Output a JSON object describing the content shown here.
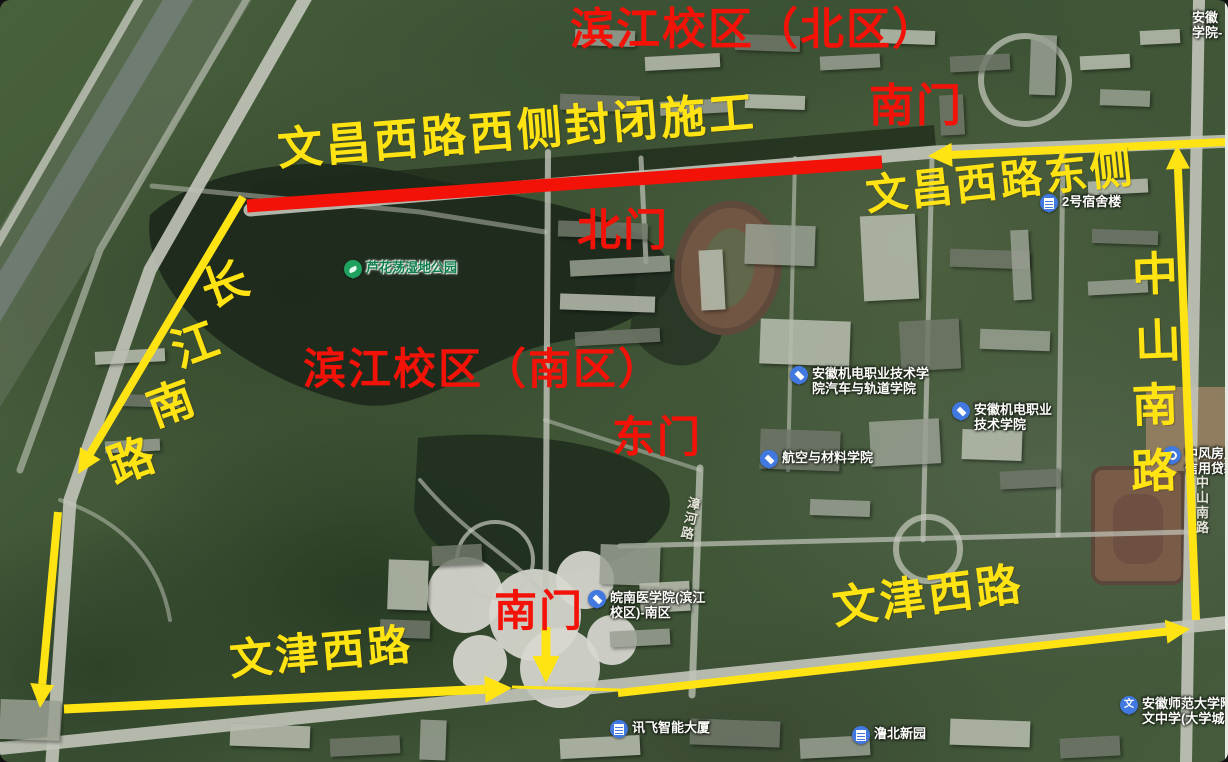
{
  "colors": {
    "annotation_red": "#f31208",
    "annotation_yellow": "#ffe312",
    "poi_blue": "#4179e0",
    "poi_green": "#1fa15f"
  },
  "annotations": {
    "red_texts": [
      {
        "id": "campus-north-title",
        "text": "滨江校区（北区）",
        "x": 570,
        "y": 8,
        "size": 44,
        "rotate": 0
      },
      {
        "id": "south-gate-north-campus",
        "text": "南门",
        "x": 869,
        "y": 84,
        "size": 45,
        "rotate": 0
      },
      {
        "id": "north-gate",
        "text": "北门",
        "x": 577,
        "y": 209,
        "size": 44,
        "rotate": 0
      },
      {
        "id": "campus-south-title",
        "text": "滨江校区（南区）",
        "x": 303,
        "y": 349,
        "size": 43,
        "rotate": 0
      },
      {
        "id": "east-gate",
        "text": "东门",
        "x": 612,
        "y": 417,
        "size": 43,
        "rotate": 0
      },
      {
        "id": "south-gate-south-campus",
        "text": "南门",
        "x": 494,
        "y": 591,
        "size": 43,
        "rotate": 0
      }
    ],
    "yellow_texts": [
      {
        "id": "closure-notice",
        "text": "文昌西路西侧封闭施工",
        "x": 276,
        "y": 128,
        "size": 45,
        "rotate": -4.5
      },
      {
        "id": "wenchang-east-label",
        "text": "文昌西路东侧",
        "x": 864,
        "y": 176,
        "size": 42,
        "rotate": -6
      },
      {
        "id": "wenjin-west-label-left",
        "text": "文津西路",
        "x": 228,
        "y": 640,
        "size": 43,
        "rotate": -5
      },
      {
        "id": "wenjin-west-label-right",
        "text": "文津西路",
        "x": 830,
        "y": 587,
        "size": 45,
        "rotate": -7.5
      }
    ],
    "vertical_texts": [
      {
        "id": "changjiang-south-road",
        "text": "长江南路",
        "size": 46,
        "rotate": -20,
        "chars": [
          {
            "c": "长",
            "x": 202,
            "y": 262
          },
          {
            "c": "江",
            "x": 172,
            "y": 322
          },
          {
            "c": "南",
            "x": 148,
            "y": 381
          },
          {
            "c": "路",
            "x": 108,
            "y": 438
          }
        ]
      },
      {
        "id": "zhongshan-south-road",
        "text": "中山南路",
        "size": 46,
        "rotate": -2,
        "chars": [
          {
            "c": "中",
            "x": 1132,
            "y": 252
          },
          {
            "c": "山",
            "x": 1135,
            "y": 319
          },
          {
            "c": "南",
            "x": 1132,
            "y": 383
          },
          {
            "c": "路",
            "x": 1131,
            "y": 449
          }
        ]
      }
    ],
    "red_line": {
      "id": "closure-red-line",
      "x1": 247,
      "y1": 206,
      "x2": 882,
      "y2": 162,
      "width": 13
    },
    "arrows": [
      {
        "id": "arrow-changjiang-upper",
        "x1": 243,
        "y1": 197,
        "x2": 78,
        "y2": 474,
        "width": 8
      },
      {
        "id": "arrow-changjiang-lower",
        "x1": 58,
        "y1": 512,
        "x2": 40,
        "y2": 708,
        "width": 8
      },
      {
        "id": "arrow-wenchang-westbound",
        "x1": 1226,
        "y1": 142,
        "x2": 928,
        "y2": 156,
        "width": 8
      },
      {
        "id": "arrow-zhongshan-northbound",
        "x1": 1196,
        "y1": 620,
        "x2": 1177,
        "y2": 145,
        "width": 8
      },
      {
        "id": "arrow-wenjin-eastbound-left",
        "x1": 64,
        "y1": 709,
        "x2": 512,
        "y2": 688,
        "width": 9
      },
      {
        "id": "arrow-wenjin-eastbound-right",
        "x1": 618,
        "y1": 693,
        "x2": 1190,
        "y2": 629,
        "width": 8
      },
      {
        "id": "arrow-south-gate-down",
        "x1": 546,
        "y1": 627,
        "x2": 546,
        "y2": 683,
        "width": 9
      }
    ],
    "thin_lines": [
      {
        "id": "wenjin-connector",
        "x1": 512,
        "y1": 687,
        "x2": 620,
        "y2": 690,
        "width": 3
      }
    ]
  },
  "pois": [
    {
      "id": "luhuadang-wetland-park",
      "lines": [
        "芦花荡湿地公园"
      ],
      "x": 344,
      "y": 260,
      "pin": "leaf",
      "style": "green"
    },
    {
      "id": "dormitory-2",
      "lines": [
        "2号宿舍楼"
      ],
      "x": 1040,
      "y": 194,
      "pin": "building",
      "style": "blue"
    },
    {
      "id": "jidian-auto-rail-college",
      "lines": [
        "安徽机电职业技术学",
        "院汽车与轨道学院"
      ],
      "x": 790,
      "y": 366,
      "pin": "grad",
      "style": "blue"
    },
    {
      "id": "jidian-vocational-college",
      "lines": [
        "安徽机电职业",
        "技术学院"
      ],
      "x": 952,
      "y": 402,
      "pin": "grad",
      "style": "blue"
    },
    {
      "id": "aero-materials-college",
      "lines": [
        "航空与材料学院"
      ],
      "x": 760,
      "y": 450,
      "pin": "grad",
      "style": "blue"
    },
    {
      "id": "wannan-medical-south",
      "lines": [
        "皖南医学院(滨江",
        "校区)-南区"
      ],
      "x": 588,
      "y": 590,
      "pin": "grad",
      "style": "blue"
    },
    {
      "id": "zhongfeng-property-loan",
      "lines": [
        "中风房产",
        "信用贷款"
      ],
      "x": 1163,
      "y": 446,
      "pin": "dot",
      "style": "blue"
    },
    {
      "id": "xunfei-tower",
      "lines": [
        "讯飞智能大厦"
      ],
      "x": 610,
      "y": 720,
      "pin": "building",
      "style": "blue"
    },
    {
      "id": "lubei-xinyuan",
      "lines": [
        "澛北新园"
      ],
      "x": 852,
      "y": 726,
      "pin": "building",
      "style": "blue"
    },
    {
      "id": "anhui-normal-attached-school",
      "lines": [
        "安徽师范大学附",
        "文中学(大学城校"
      ],
      "x": 1120,
      "y": 696,
      "pin": "wen",
      "style": "blue"
    },
    {
      "id": "top-right-college",
      "lines": [
        "安徽",
        "学院-"
      ],
      "x": 1192,
      "y": 10,
      "pin": "none",
      "style": "plain"
    }
  ],
  "road_labels": [
    {
      "id": "zhanghe-road",
      "text": "漳河路",
      "x": 684,
      "y": 497,
      "rotate": 12
    },
    {
      "id": "zhongshan-road-basemap",
      "text": "中山南路",
      "x": 1196,
      "y": 476,
      "rotate": 0
    }
  ]
}
